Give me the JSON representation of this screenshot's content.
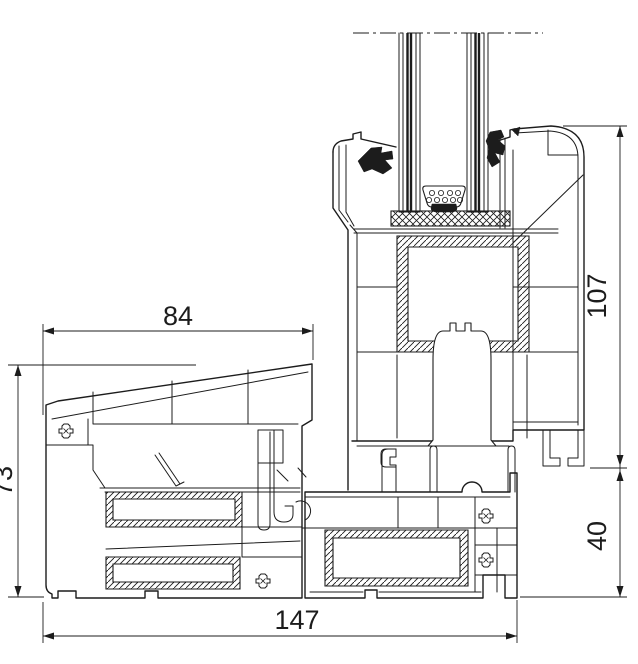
{
  "drawing": {
    "description": "PVC window profile cross-section",
    "dimensions": {
      "top_width": "84",
      "left_height": "73",
      "sash_height": "107",
      "frame_height": "40",
      "bottom_width": "147"
    }
  },
  "colors": {
    "line": "#1c1c1c",
    "background": "#ffffff"
  }
}
